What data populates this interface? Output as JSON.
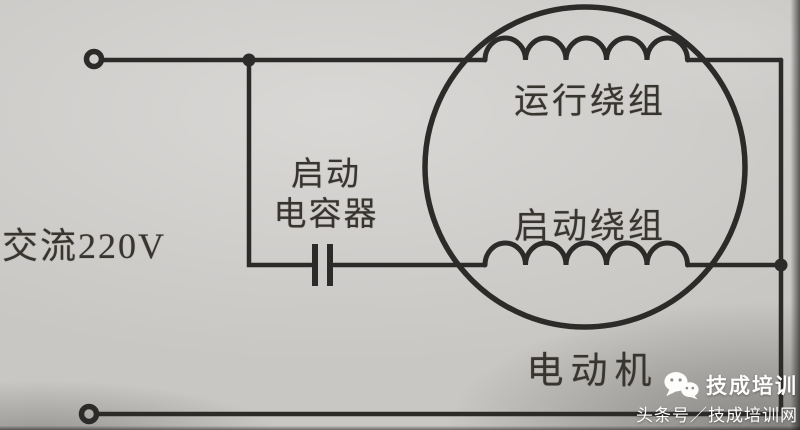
{
  "diagram": {
    "type": "circuit-diagram",
    "ac_source_label": "交流220V",
    "capacitor_label": {
      "line1": "启动",
      "line2": "电容器"
    },
    "motor": {
      "running_winding_label": "运行绕组",
      "starting_winding_label": "启动绕组",
      "motor_label": "电动机",
      "winding_turns_shown": 5
    }
  },
  "watermark": {
    "icon": "wechat-icon",
    "brand_name": "技成培训",
    "byline": "头条号／技成培训网"
  },
  "colors": {
    "ink": "#2d2b29",
    "paper": "#c9c7c4",
    "label_text": "#38342f",
    "watermark_text": "#fdfdfc"
  }
}
